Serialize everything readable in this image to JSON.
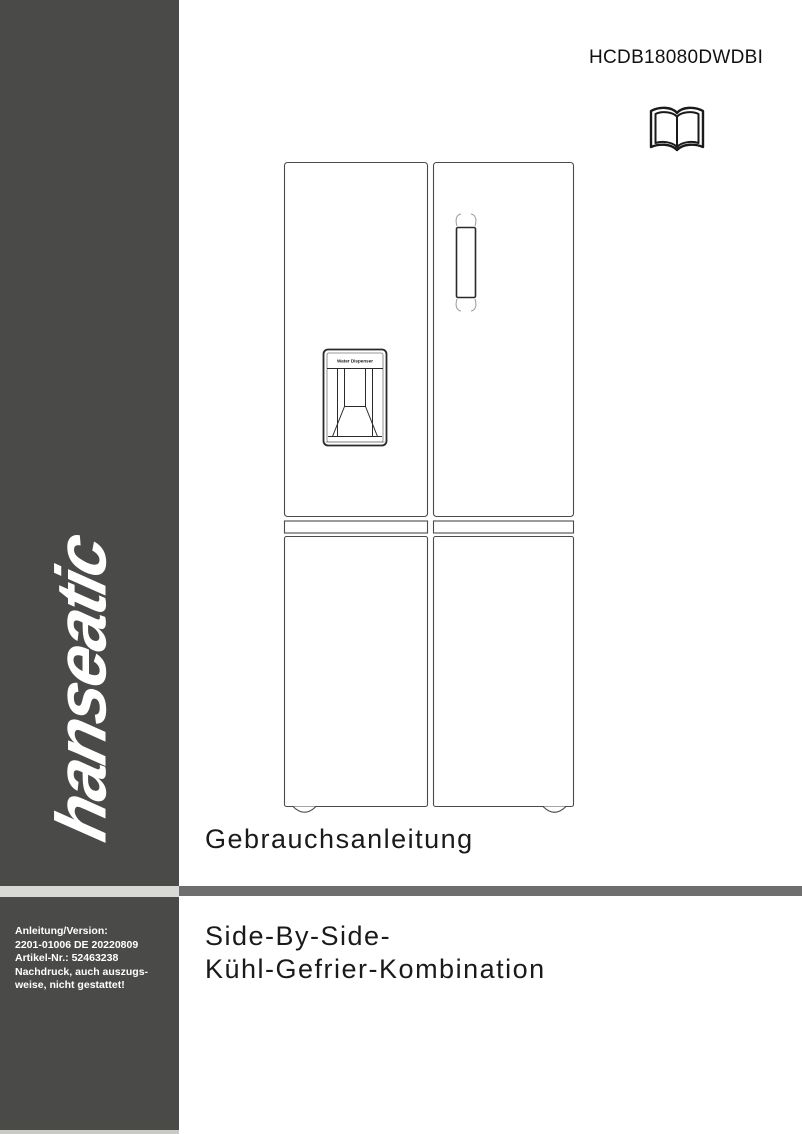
{
  "header": {
    "model_number": "HCDB18080DWDBI"
  },
  "sidebar": {
    "brand": "hanseatic",
    "imprint_lines": [
      "Anleitung/Version:",
      "2201-01006 DE 20220809",
      "Artikel-Nr.: 52463238",
      "Nachdruck, auch auszugs-",
      "weise, nicht gestattet!"
    ]
  },
  "headings": {
    "manual_label": "Gebrauchsanleitung",
    "product_title_line1": "Side-By-Side-",
    "product_title_line2": "Kühl-Gefrier-Kombination"
  },
  "illustration": {
    "dispenser_label": "Water Dispenser"
  },
  "colors": {
    "sidebar_bg": "#4a4a48",
    "divider_bar": "#6e6e6e",
    "logo_text": "#ffffff",
    "heading_text": "#1a1a1a"
  }
}
